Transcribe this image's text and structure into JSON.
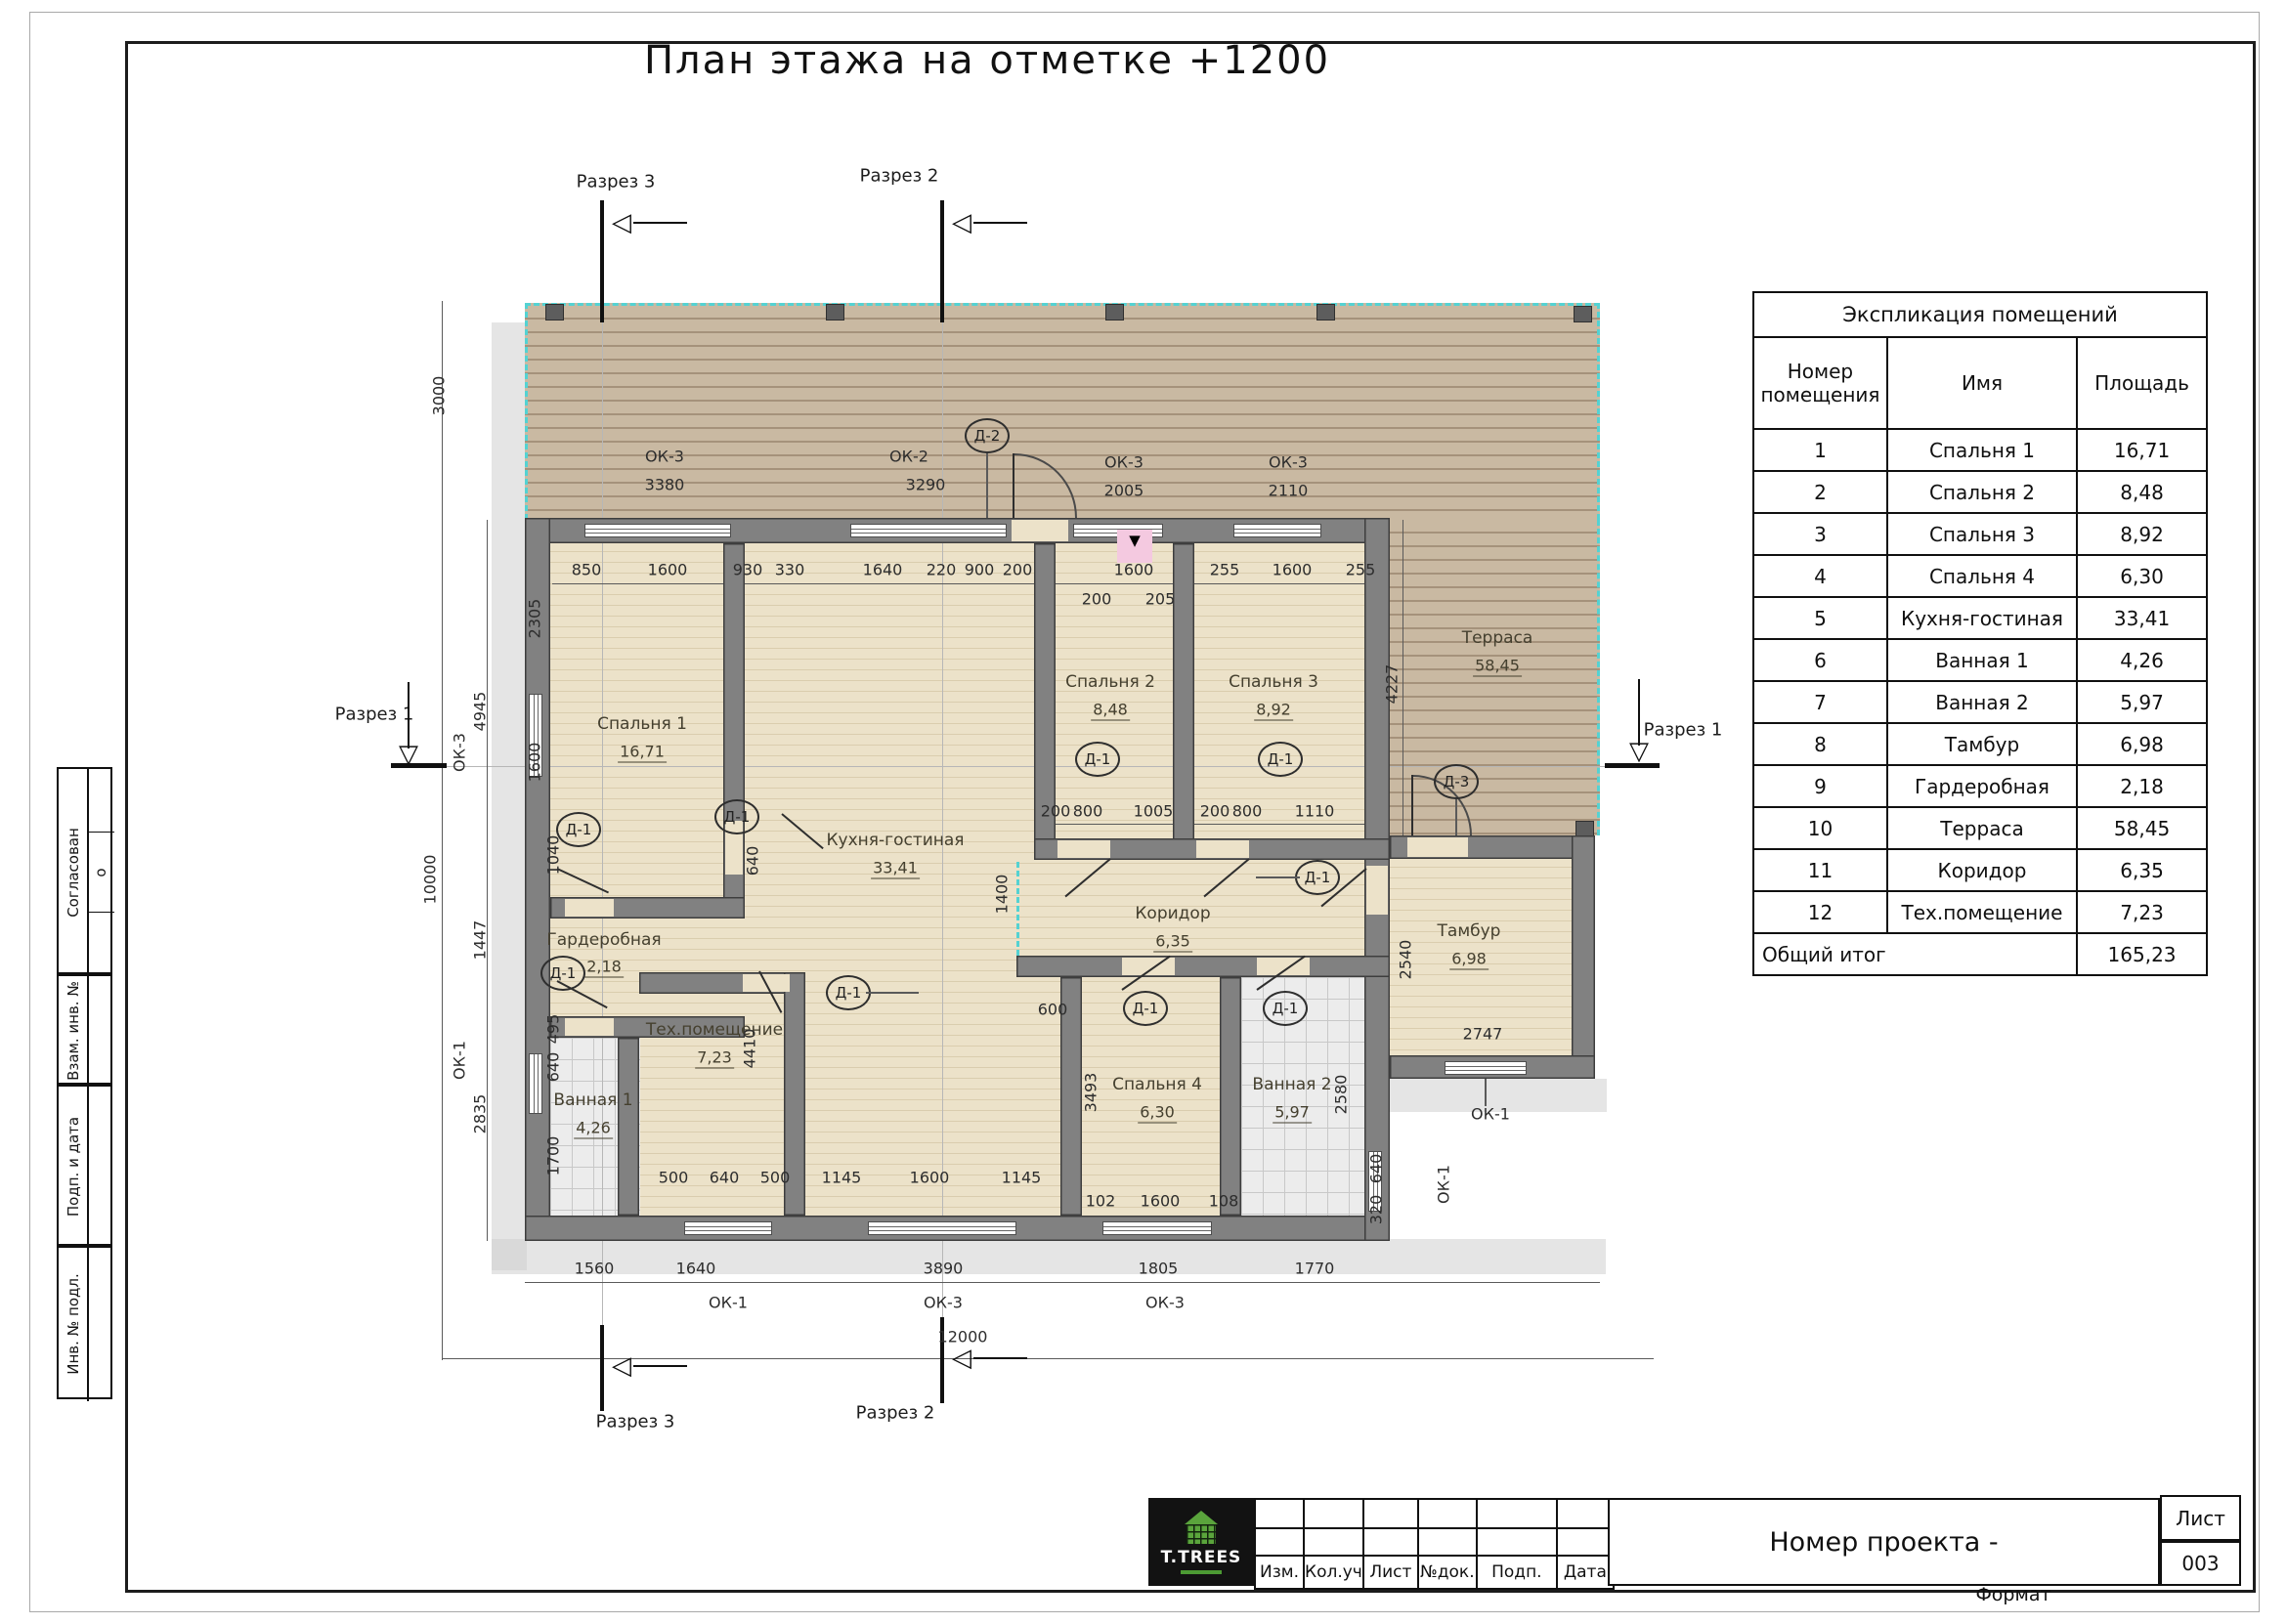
{
  "sheet": {
    "title": "План этажа на отметке +1200",
    "format_label": "Формат",
    "cursor_glyph": "▼"
  },
  "stamp_column": {
    "approved_label": "Согласован",
    "approved_value": "о",
    "row1": "Взам. инв. №",
    "row2": "Подп. и дата",
    "row3": "Инв. № подл."
  },
  "schedule": {
    "title": "Экспликация помещений",
    "col_number_line1": "Номер",
    "col_number_line2": "помещения",
    "col_name": "Имя",
    "col_area": "Площадь",
    "rows": [
      {
        "num": "1",
        "name": "Спальня 1",
        "area": "16,71"
      },
      {
        "num": "2",
        "name": "Спальня 2",
        "area": "8,48"
      },
      {
        "num": "3",
        "name": "Спальня 3",
        "area": "8,92"
      },
      {
        "num": "4",
        "name": "Спальня 4",
        "area": "6,30"
      },
      {
        "num": "5",
        "name": "Кухня-гостиная",
        "area": "33,41"
      },
      {
        "num": "6",
        "name": "Ванная 1",
        "area": "4,26"
      },
      {
        "num": "7",
        "name": "Ванная 2",
        "area": "5,97"
      },
      {
        "num": "8",
        "name": "Тамбур",
        "area": "6,98"
      },
      {
        "num": "9",
        "name": "Гардеробная",
        "area": "2,18"
      },
      {
        "num": "10",
        "name": "Терраса",
        "area": "58,45"
      },
      {
        "num": "11",
        "name": "Коридор",
        "area": "6,35"
      },
      {
        "num": "12",
        "name": "Тех.помещение",
        "area": "7,23"
      }
    ],
    "total_label": "Общий итог",
    "total_area": "165,23"
  },
  "titleblock": {
    "logo_text": "T.TREES",
    "cols": [
      "Изм.",
      "Кол.уч",
      "Лист",
      "№док.",
      "Подп.",
      "Дата"
    ],
    "project_label": "Номер проекта -",
    "sheet_label": "Лист",
    "sheet_number": "003"
  },
  "plan": {
    "rooms": [
      {
        "name": "Спальня 1",
        "area": "16,71"
      },
      {
        "name": "Спальня 2",
        "area": "8,48"
      },
      {
        "name": "Спальня 3",
        "area": "8,92"
      },
      {
        "name": "Спальня 4",
        "area": "6,30"
      },
      {
        "name": "Кухня-гостиная",
        "area": "33,41"
      },
      {
        "name": "Ванная 1",
        "area": "4,26"
      },
      {
        "name": "Ванная 2",
        "area": "5,97"
      },
      {
        "name": "Тамбур",
        "area": "6,98"
      },
      {
        "name": "Гардеробная",
        "area": "2,18"
      },
      {
        "name": "Терраса",
        "area": "58,45"
      },
      {
        "name": "Коридор",
        "area": "6,35"
      },
      {
        "name": "Тех.помещение",
        "area": "7,23"
      }
    ],
    "sections": {
      "s1": "Разрез 1",
      "s2": "Разрез 2",
      "s3": "Разрез 3"
    },
    "tags": {
      "d1": "Д-1",
      "d2": "Д-2",
      "d3": "Д-3",
      "ok1": "ОК-1",
      "ok2": "ОК-2",
      "ok3": "ОК-3"
    },
    "win_dims": {
      "t1": "3380",
      "t2": "3290",
      "t3": "2005",
      "t4": "2110"
    },
    "dims": {
      "top": [
        "850",
        "1600",
        "930",
        "330",
        "1640",
        "220",
        "900",
        "200",
        "1600",
        "255",
        "1600",
        "255"
      ],
      "sub_top": [
        "200",
        "205"
      ],
      "mid": [
        "200",
        "800",
        "1005",
        "200",
        "800",
        "1110"
      ],
      "inner_bottom": [
        "500",
        "640",
        "500",
        "1145",
        "1600",
        "1145",
        "102",
        "1600",
        "108"
      ],
      "outer_bottom": [
        "1560",
        "1640",
        "3890",
        "1805",
        "1770"
      ],
      "total_width": "12000",
      "left_outer": [
        "3000",
        "4945",
        "10000",
        "1447",
        "2835"
      ],
      "left_inner": [
        "2305",
        "1600",
        "1040",
        "495",
        "640",
        "1700"
      ],
      "right": [
        "4227",
        "2540",
        "2747",
        "2580",
        "640",
        "320"
      ],
      "center": [
        "640",
        "4410",
        "1400",
        "600",
        "3493"
      ]
    }
  }
}
